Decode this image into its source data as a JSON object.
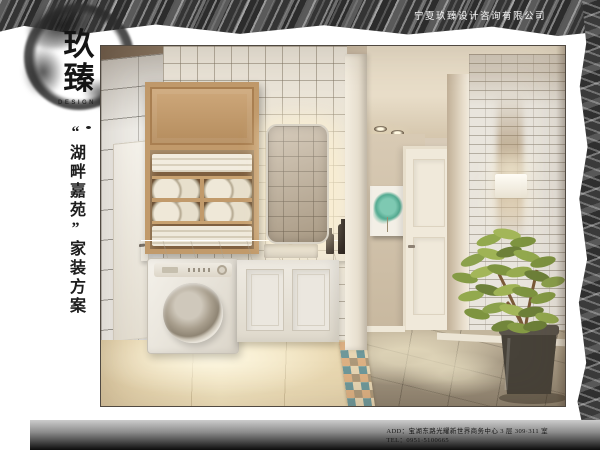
{
  "brand": {
    "logo_char_top": "玖",
    "logo_char_bottom": "臻",
    "logo_subtitle": "DESIGN",
    "seal_char_top": "玖",
    "seal_char_bottom": "臻",
    "company_name": "宁夏玖臻设计咨询有限公司"
  },
  "title": {
    "project": "“湖畔嘉苑”家装方案"
  },
  "footer": {
    "address": "ADD：宝湖东路光耀新世界商务中心 3 层 309·311 室",
    "telephone": "TEL：0951·5100665"
  },
  "palette": {
    "seal_red": "#b23a2e",
    "ink_black": "#1f1f1f",
    "brush_gray": "#3a3a3a",
    "cabinet_wood": "#c19a6b",
    "artwork_teal": "#66bfa4",
    "wall_beige": "#d6c6ae",
    "mosaic_teal": "#6e989a",
    "mosaic_orange": "#d69864"
  }
}
